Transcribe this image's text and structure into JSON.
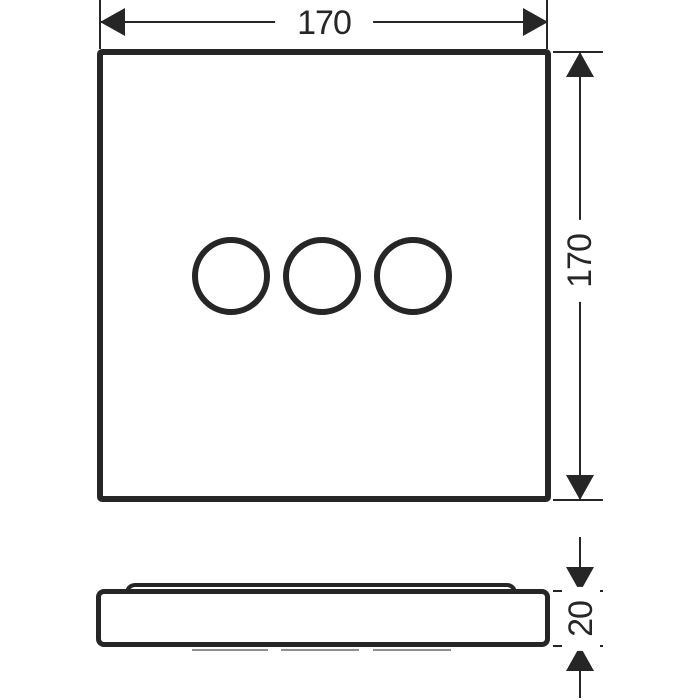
{
  "drawing": {
    "background_color": "#ffffff",
    "line_color": "#262626",
    "front_view": {
      "circle_count": 3
    },
    "dimensions": {
      "width": "170",
      "height": "170",
      "thickness": "20"
    }
  }
}
